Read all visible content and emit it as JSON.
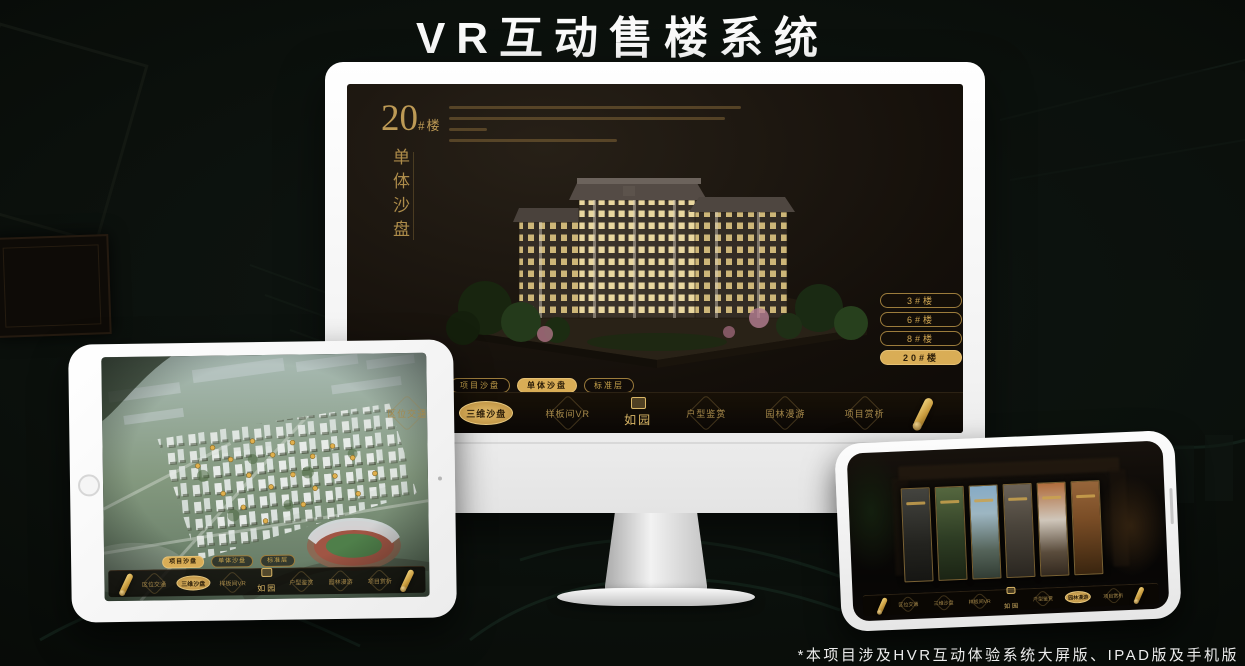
{
  "title": "VR互动售楼系统",
  "footnote": "*本项目涉及HVR互动体验系统大屏版、IPAD版及手机版",
  "brand": {
    "logo": "如园",
    "gold": "#d9ad56",
    "gold_dim": "#9c7c3c",
    "screen_bg": "#140f0a"
  },
  "app": {
    "tabs": [
      "项目沙盘",
      "单体沙盘",
      "标准层"
    ],
    "nav_left": [
      "区位交通",
      "三维沙盘",
      "样板间VR"
    ],
    "nav_right": [
      "户型鉴赏",
      "园林漫游",
      "项目赏析"
    ]
  },
  "monitor_screen": {
    "building_no": "20",
    "building_no_suffix": "#楼",
    "subtitle": "单体沙盘",
    "floor_buttons": [
      "3#楼",
      "6#楼",
      "8#楼",
      "20#楼"
    ],
    "active_floor": "20#楼",
    "active_tab": "单体沙盘",
    "active_nav": "三维沙盘"
  },
  "tablet_screen": {
    "active_tab": "项目沙盘",
    "active_nav": "三维沙盘"
  },
  "phone_screen": {
    "active_nav": "园林漫游"
  }
}
